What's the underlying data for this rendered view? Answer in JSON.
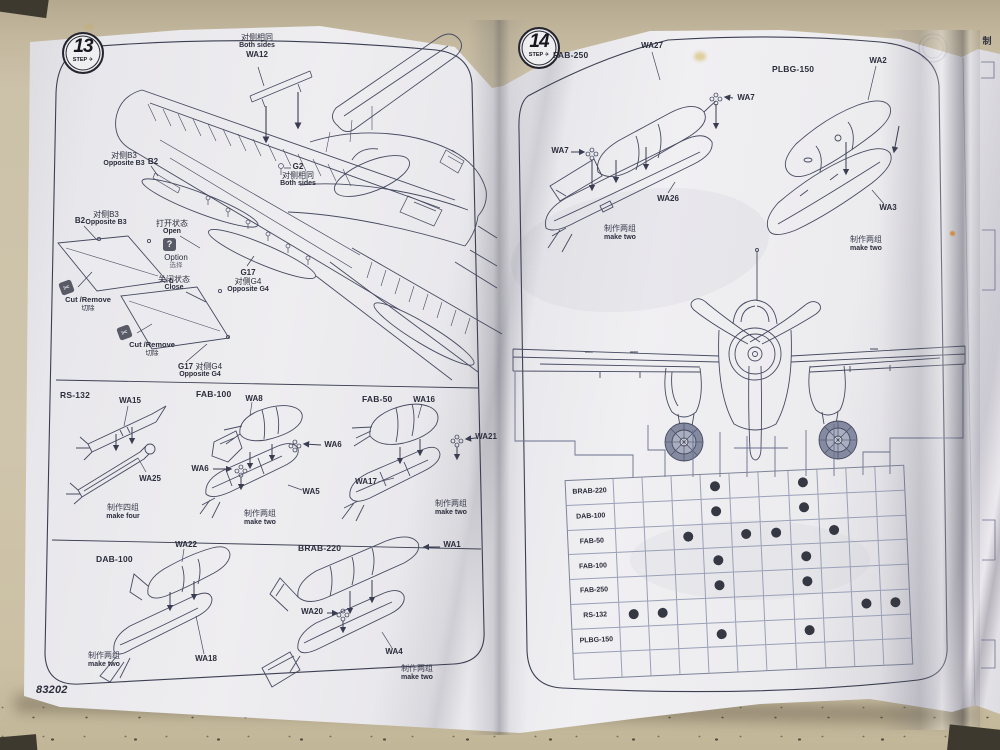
{
  "photo": {
    "surface_color": "#cfc5ac",
    "paper_color": "#eceaee",
    "ink_color": "#40435a"
  },
  "left_page": {
    "step_badge": {
      "number": "13",
      "label": "STEP",
      "icon": "plane-icon",
      "icon_glyph": "✈"
    },
    "product_code": "83202",
    "annotations": {
      "both_sides_wa12": {
        "zh": "对侧相同",
        "en": "Both sides",
        "part": "WA12"
      },
      "opposite_b3_top": {
        "zh": "对侧B3",
        "en": "Opposite B3",
        "part": "B2"
      },
      "opposite_b3_left": {
        "part": "B2",
        "zh": "对侧B3",
        "en": "Opposite B3"
      },
      "open_state": {
        "zh": "打开状态",
        "en": "Open"
      },
      "option": {
        "glyph": "?",
        "en": "Option",
        "zh": "选择"
      },
      "close_state": {
        "zh": "关闭状态",
        "en": "Close"
      },
      "cut_remove": {
        "icon": "scissors-icon",
        "icon_glyph": "✂",
        "en": "Cut /Remove",
        "zh": "切除"
      },
      "g2_both_sides": {
        "part": "G2",
        "zh": "对侧相同",
        "en": "Both sides"
      },
      "g17_right": {
        "part": "G17",
        "zh": "对侧G4",
        "en": "Opposite G4"
      },
      "g17_bottom": {
        "part": "G17",
        "zh": "对侧G4",
        "en": "Opposite G4"
      }
    },
    "bomb_groups": {
      "rs132": {
        "name": "RS-132",
        "top_part": "WA15",
        "bottom_part": "WA25",
        "qty_zh": "制作四组",
        "qty_en": "make four"
      },
      "fab100": {
        "name": "FAB-100",
        "top_part": "WA8",
        "fuse_part_left": "WA6",
        "fuse_part_right": "WA6",
        "bottom_part": "WA5",
        "qty_zh": "制作两组",
        "qty_en": "make two"
      },
      "fab50": {
        "name": "FAB-50",
        "top_part": "WA16",
        "fuse_part": "WA21",
        "bottom_part": "WA17",
        "qty_zh": "制作两组",
        "qty_en": "make two"
      },
      "dab100": {
        "name": "DAB-100",
        "top_part": "WA22",
        "bottom_part": "WA18",
        "qty_zh": "制作两组",
        "qty_en": "make two"
      },
      "brab220": {
        "name": "BRAB-220",
        "top_part": "WA1",
        "fuse_part": "WA20",
        "bottom_part": "WA4",
        "qty_zh": "制作两组",
        "qty_en": "make two"
      }
    }
  },
  "right_page": {
    "step_badge": {
      "number": "14",
      "label": "STEP",
      "icon": "plane-icon",
      "icon_glyph": "✈"
    },
    "fab250": {
      "name": "FAB-250",
      "top_part": "WA27",
      "fuse_part_left": "WA7",
      "fuse_part_right": "WA7",
      "bottom_part": "WA26",
      "qty_zh": "制作两组",
      "qty_en": "make two"
    },
    "plbg150": {
      "name": "PLBG-150",
      "top_part": "WA2",
      "bottom_part": "WA3",
      "qty_zh": "制作两组",
      "qty_en": "make two"
    },
    "loadout_table": {
      "columns": 10,
      "rows": [
        {
          "label": "BRAB-220",
          "dots": [
            4,
            7
          ]
        },
        {
          "label": "DAB-100",
          "dots": [
            4,
            7
          ]
        },
        {
          "label": "FAB-50",
          "dots": [
            3,
            5,
            6,
            8
          ]
        },
        {
          "label": "FAB-100",
          "dots": [
            4,
            7
          ]
        },
        {
          "label": "FAB-250",
          "dots": [
            4,
            7
          ]
        },
        {
          "label": "RS-132",
          "dots": [
            1,
            2,
            9,
            10
          ]
        },
        {
          "label": "PLBG-150",
          "dots": [
            4,
            7
          ]
        },
        {
          "label": "",
          "dots": []
        }
      ]
    }
  },
  "next_page": {
    "edge_char": "制"
  }
}
